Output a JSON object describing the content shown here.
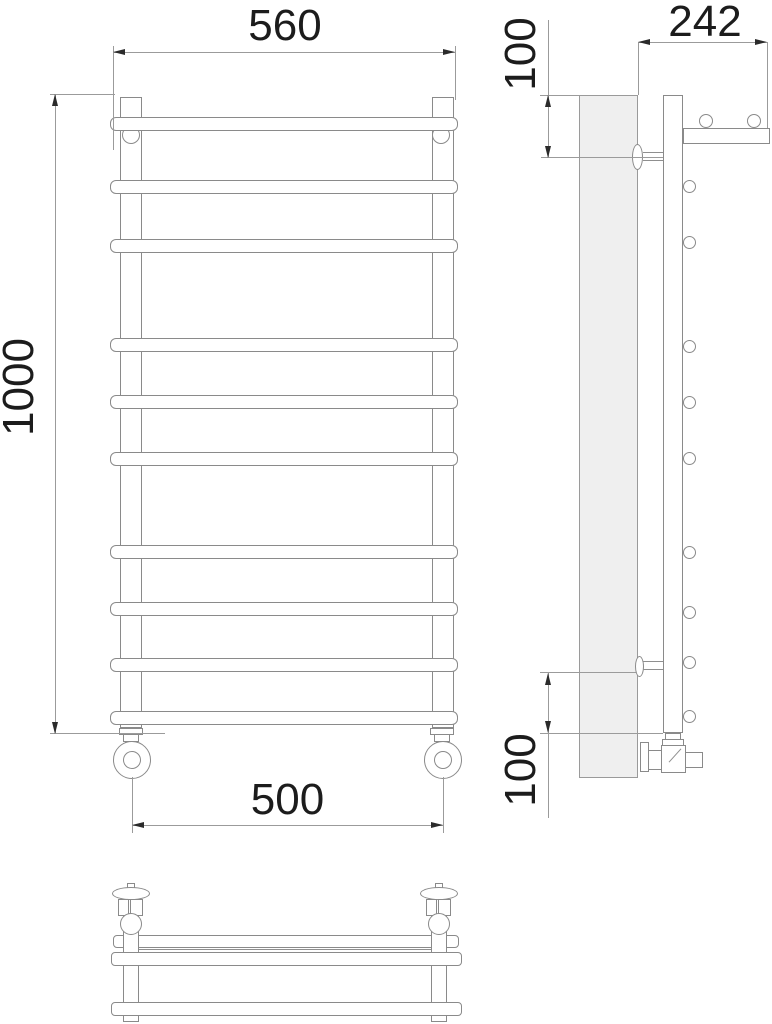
{
  "drawing": {
    "title": "ladder-towel-rail-dimension-drawing",
    "dimensions": {
      "overall_width": "560",
      "overall_height": "1000",
      "connection_spacing": "500",
      "depth": "242",
      "top_bracket_offset": "100",
      "bottom_bracket_offset": "100"
    },
    "views": {
      "front": "front-view",
      "side": "side-view",
      "plan": "plan-view"
    },
    "accent_colors": {
      "line": "#8a8a8a",
      "wall_fill": "#efefef",
      "text": "#1c1c1c"
    }
  }
}
